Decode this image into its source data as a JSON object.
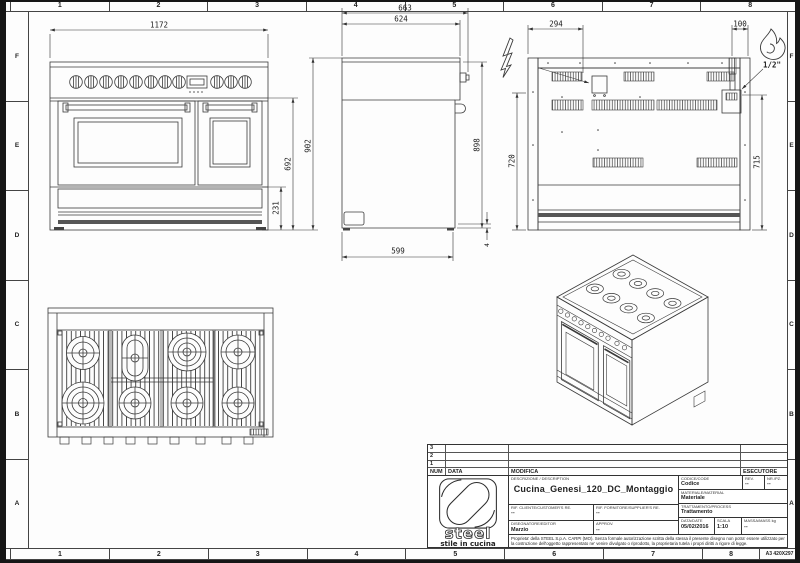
{
  "sheet": {
    "columns": [
      "1",
      "2",
      "3",
      "4",
      "5",
      "6",
      "7",
      "8"
    ],
    "rows": [
      "F",
      "E",
      "D",
      "C",
      "B",
      "A"
    ],
    "format": "A3 420X297"
  },
  "symbols": {
    "electric": "lightning-bolt",
    "gas": "flame"
  },
  "dims": {
    "front": {
      "width": "1172",
      "total_height": "902",
      "oven_height": "692",
      "base_height": "231"
    },
    "side": {
      "total_depth": "663",
      "body_depth": "624",
      "height": "898",
      "bottom_depth": "599",
      "feet": "4"
    },
    "back": {
      "electric_offset": "294",
      "gas_offset": "100",
      "left_height": "720",
      "gas_height": "715",
      "gas_thread": "1/2\""
    }
  },
  "title_block": {
    "revisions": {
      "rows": [
        "3",
        "2",
        "1"
      ],
      "num": "NUM",
      "data": "DATA",
      "modifica": "MODIFICA",
      "esecutore": "ESECUTORE"
    },
    "logo": {
      "brand": "steel",
      "tagline": "stile in cucina"
    },
    "description_label": "DESCRIZIONE / DESCRIPTION",
    "description": "Cucina_Genesi_120_DC_Montaggio",
    "codice_label": "CODICE/CODE",
    "codice": "Codice",
    "rev_label": "REV.",
    "rev": "--",
    "nr_label": "NR./PZ.",
    "nr": "--",
    "materiale_label": "MATERIALE/MATERIAL",
    "materiale": "Materiale",
    "rif_cliente_label": "RIF. CLIENTE/CUSTOMER'S RE.",
    "rif_cliente": "--",
    "rif_fornitore_label": "RIF. FORNITORE/SUPPLIER'S RE.",
    "rif_fornitore": "--",
    "trattamento_label": "TRATTAMENTO/PROCESS",
    "trattamento": "Trattamento",
    "disegnatore_label": "DISEGNATORE/EDITOR",
    "disegnatore": "Marzio",
    "approv_label": "APPROV.",
    "approv": "--",
    "data_label": "DATA/DATE",
    "data": "05/02/2016",
    "scala_label": "SCALA",
    "scala": "1:10",
    "massa_label": "MASSA/MASS kg",
    "massa": "--",
    "legal": "Proprieta' della STEEL S.p.A. CARPI (MO). Senza formale autorizzazione scritta della stessa il presente disegno non potra' essere utilizzato per la costruzione dell'oggetto rappresentato ne' venire divulgato o riprodotto, la proprietaria tutela i propri diritti a rigore di legge."
  }
}
